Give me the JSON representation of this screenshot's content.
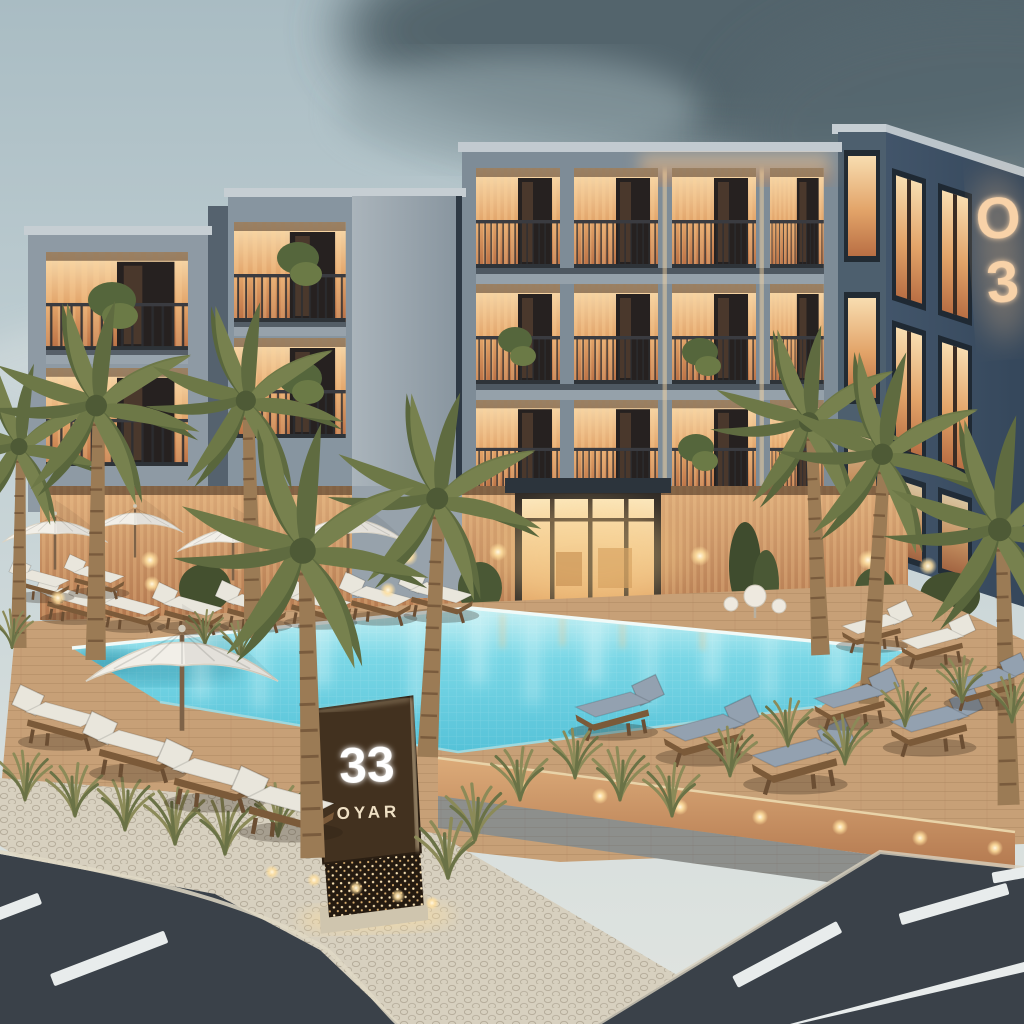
{
  "signboard": {
    "number": "33",
    "word": "OYAR"
  },
  "facade_sign": {
    "top_char": "O",
    "bottom_char": "3"
  },
  "palette": {
    "sky": "#c2d0d4",
    "storm_cloud": "#4f6068",
    "facade_light": "#a3aeb5",
    "facade_mid": "#7e8c97",
    "facade_dark_side": "#3c4f63",
    "balcony_glow": "#f0b478",
    "wood_slat": "#a46f4e",
    "window_dark": "#262120",
    "palm_green": "#6d7847",
    "palm_trunk": "#9b7b55",
    "pool_water": "#6fd2e2",
    "pool_light": "#c8f1f4",
    "deck": "#c7a077",
    "cobblestone": "#d7d0bf",
    "stone_wall": "#b2906c",
    "road": "#3a4149",
    "road_marking": "#e8ecec",
    "cushion_white": "#e9e6dc",
    "cushion_blue": "#93a1b0",
    "sign_board": "#42311f",
    "sign_glow": "#ffe9c0",
    "umbrella": "#f2efe8"
  }
}
